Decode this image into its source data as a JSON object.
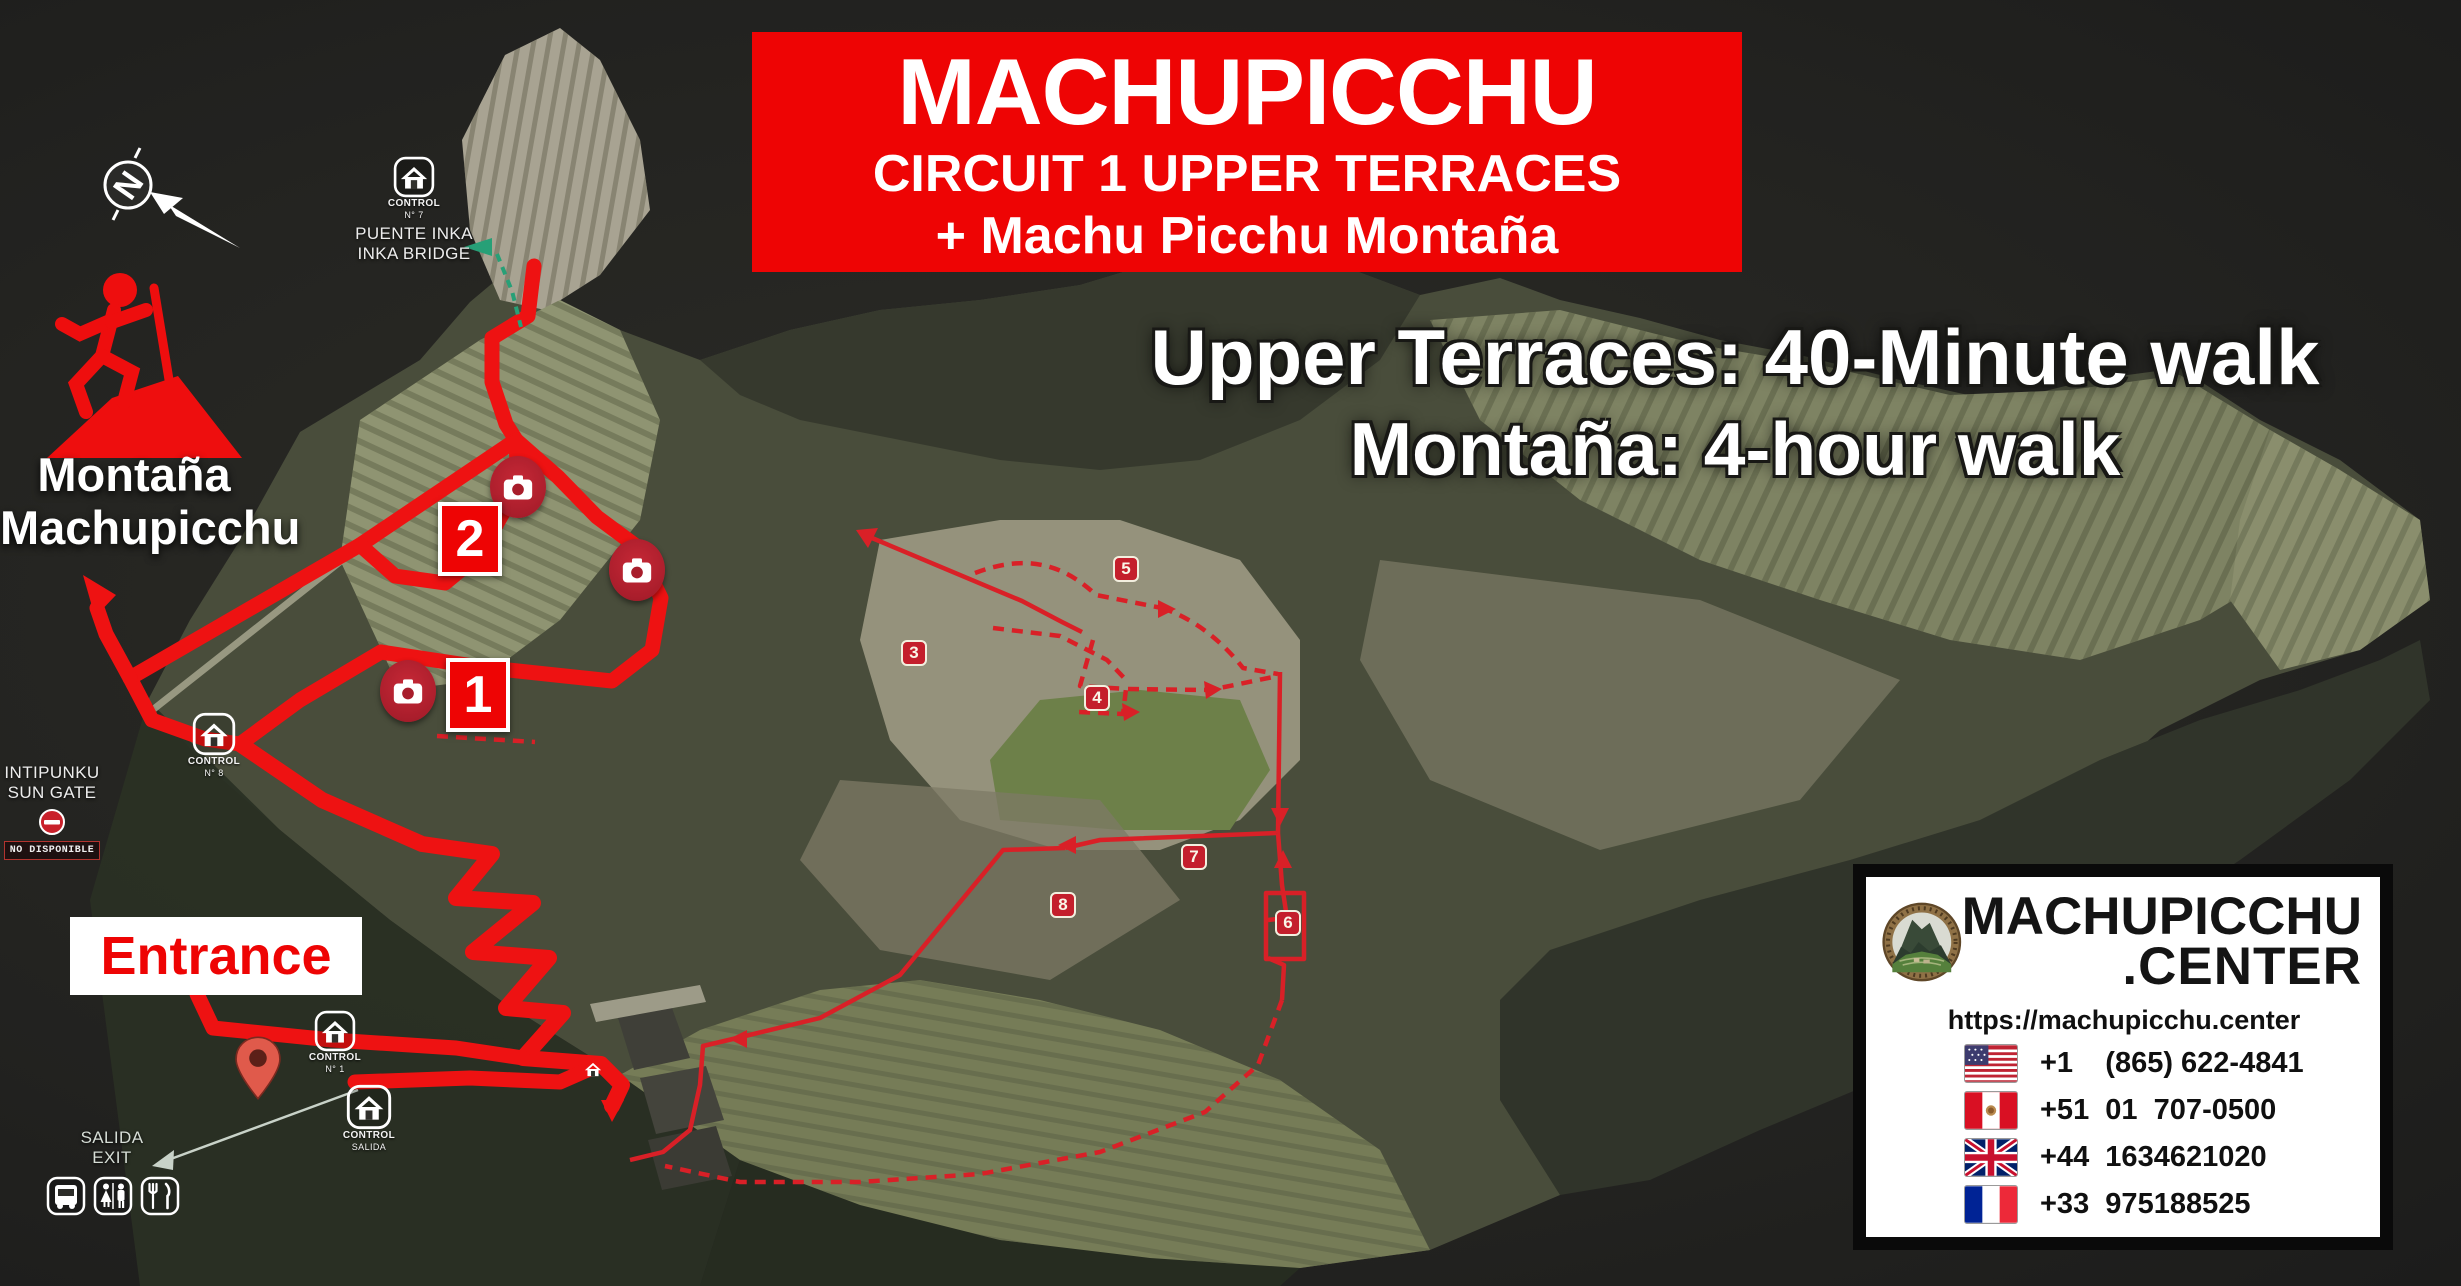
{
  "title_box": {
    "line1": "MACHUPICCHU",
    "line2": "CIRCUIT 1 UPPER TERRACES",
    "line3": "+ Machu Picchu Montaña"
  },
  "subtitle": {
    "line1": "Upper Terraces: 40-Minute walk",
    "line2": "Montaña: 4-hour walk"
  },
  "montana_label": {
    "line1": "Montaña",
    "line2": "Machupicchu"
  },
  "compass": {
    "letter": "N"
  },
  "map_labels": {
    "puente_inka": {
      "control_line1": "CONTROL",
      "control_line2": "N° 7",
      "name_line1": "PUENTE INKA",
      "name_line2": "INKA BRIDGE"
    },
    "intipunku": {
      "name_line1": "INTIPUNKU",
      "name_line2": "SUN GATE",
      "status_badge": "NO DISPONIBLE"
    },
    "control_8": {
      "control_line1": "CONTROL",
      "control_line2": "N° 8"
    },
    "control_1": {
      "control_line1": "CONTROL",
      "control_line2": "N° 1"
    },
    "control_salida": {
      "control_line1": "CONTROL",
      "control_line2": "SALIDA"
    },
    "salida_exit": {
      "line1": "SALIDA",
      "line2": "EXIT"
    },
    "entrance": "Entrance"
  },
  "waypoints": {
    "box_1": "1",
    "box_2": "2",
    "badge_3": "3",
    "badge_4": "4",
    "badge_5": "5",
    "badge_6": "6",
    "badge_7": "7",
    "badge_8": "8"
  },
  "contact_card": {
    "brand_line1": "MACHUPICCHU",
    "brand_line2": ".CENTER",
    "url": "https://machupicchu.center",
    "phones": [
      {
        "flag": "us-flag",
        "number": "+1    (865) 622-4841"
      },
      {
        "flag": "peru-flag",
        "number": "+51  01  707-0500"
      },
      {
        "flag": "uk-flag",
        "number": "+44  1634621020"
      },
      {
        "flag": "france-flag",
        "number": "+33  975188525"
      }
    ]
  },
  "colors": {
    "route_red": "#ee1212",
    "thin_route_red": "#d92027",
    "accent_red": "#ee0404",
    "badge_red": "#c41f2c",
    "trail_teal": "#27a077"
  }
}
